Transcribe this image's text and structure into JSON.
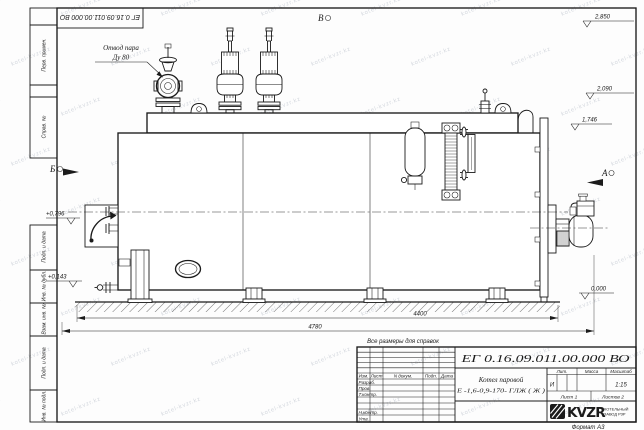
{
  "document": {
    "number": "ЕГ 0.16.09.011.00.000  ВО",
    "number_stamp_top": "ЕГ 0.16.09.011.00.000  ВО",
    "format_note": "Формат А3",
    "reference_note": "Все размеры для справок"
  },
  "drawing": {
    "callout": {
      "line1": "Отвод пара",
      "line2": "Ду 80"
    },
    "view_markers": {
      "top": "В",
      "left": "Б",
      "right": "А"
    },
    "elevations": {
      "right_top": "2,850",
      "right_mid": "2,090",
      "right_low": "1,746",
      "zero": "0,000",
      "left_upper": "+0,796",
      "left_lower": "+0,143"
    },
    "dimensions": {
      "inner": "4400",
      "outer": "4780"
    }
  },
  "title_block": {
    "product_name_line1": "Котел паровой",
    "product_name_line2": "Е -1,6-0,9-170- ГЛЖ ( Ж )",
    "columns": {
      "izm": "Изм.",
      "list": "Лист",
      "ndokum": "N докум.",
      "podp": "Подп.",
      "data": "Дата"
    },
    "rows": {
      "razrab": "Разраб.",
      "prov": "Пров.",
      "tkontr": "Т.контр.",
      "nkontr": "Н.контр.",
      "utv": "Утв."
    },
    "lit_label": "Лит.",
    "massa_label": "Масса",
    "masshtab_label": "Масштаб",
    "lit_value": "И",
    "scale_value": "1:15",
    "sheet_label": "Лист 1",
    "sheets_label": "Листов 2",
    "logo_text": "KVZR",
    "logo_caption_line1": "КОТЕЛЬНЫЙ",
    "logo_caption_line2": "ЗАВОД РЗР"
  },
  "margin_stamp": {
    "perv_primen": "Перв. примен.",
    "sprav_n": "Справ. №",
    "podp_data_1": "Подп. и дата",
    "inv_dubl": "Инв. № дубл.",
    "vzam_inv": "Взам. инв. №",
    "podp_data_2": "Подп. и дата",
    "inv_podl": "Инв. № подл."
  },
  "watermark": {
    "text": "kotel-kvzr.kz"
  }
}
